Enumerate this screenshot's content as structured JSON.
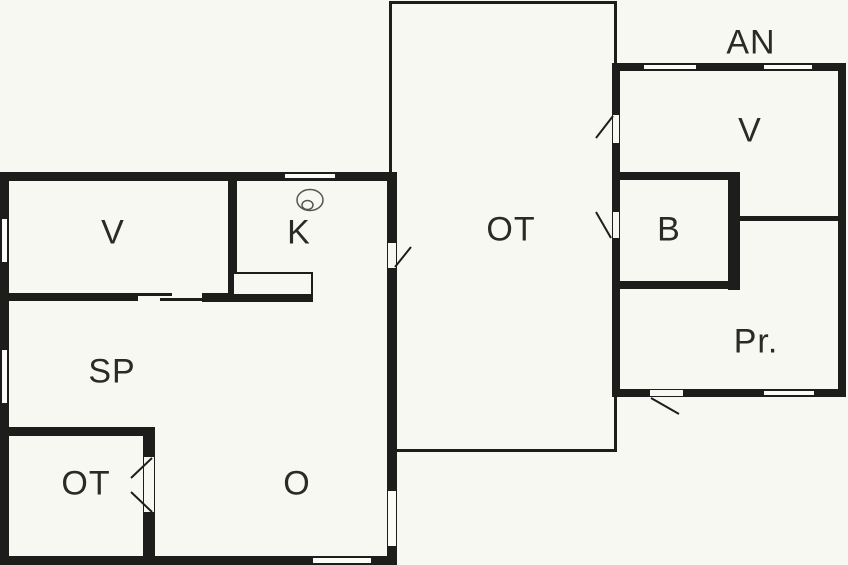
{
  "title": "Floor plan",
  "colors": {
    "background": "#f8f8f3",
    "walls": "#1d1d1b",
    "text": "#2a2a28",
    "fixture_outline": "#55554f"
  },
  "rooms": {
    "left_building": {
      "v": "V",
      "k": "K",
      "sp": "SP",
      "ot": "OT",
      "o": "O"
    },
    "middle_building": {
      "ot": "OT"
    },
    "right_building": {
      "name": "AN",
      "v": "V",
      "b": "B",
      "pr": "Pr."
    }
  },
  "fixtures": {
    "kitchen_lamp": "lamp-icon"
  }
}
